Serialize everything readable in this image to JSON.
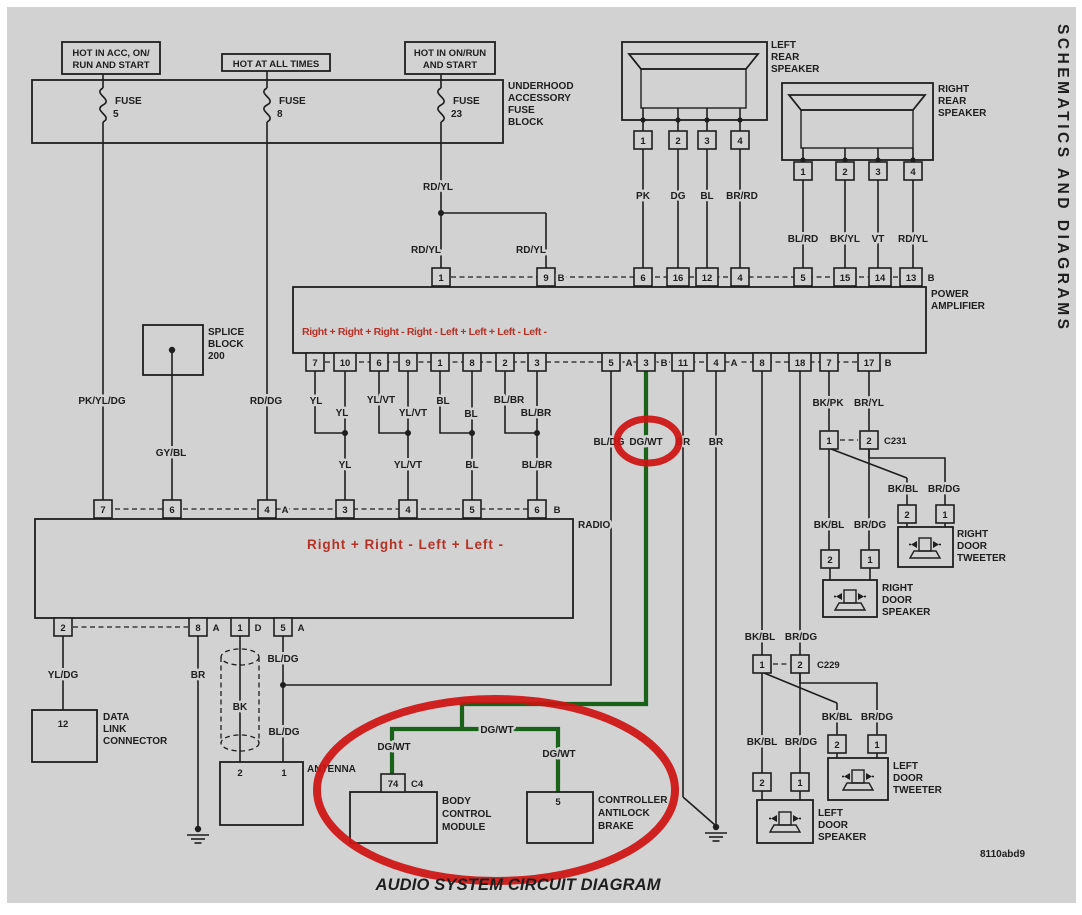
{
  "side_text": "SCHEMATICS AND DIAGRAMS",
  "caption": "AUDIO SYSTEM CIRCUIT DIAGRAM",
  "doc_code": "8110abd9",
  "colors": {
    "background": "#d2d2d2",
    "line": "#1e1e1e",
    "wire_green": "#1a611a",
    "annotation_red": "#cd1312",
    "channel_text_red": "#b53227"
  },
  "power": {
    "hot1_line1": "HOT IN ACC, ON/",
    "hot1_line2": "RUN AND START",
    "hot2": "HOT AT ALL TIMES",
    "hot3_line1": "HOT IN ON/RUN",
    "hot3_line2": "AND START",
    "block_line1": "UNDERHOOD",
    "block_line2": "ACCESSORY",
    "block_line3": "FUSE",
    "block_line4": "BLOCK",
    "fuse_word": "FUSE",
    "fuse1": "5",
    "fuse2": "8",
    "fuse3": "23"
  },
  "wire": {
    "rdyl": "RD/YL",
    "pkyldg": "PK/YL/DG",
    "rddg": "RD/DG",
    "gybl": "GY/BL",
    "yl": "YL",
    "ylvt": "YL/VT",
    "bl": "BL",
    "blbr": "BL/BR",
    "bldg": "BL/DG",
    "dgwt": "DG/WT",
    "br": "BR",
    "pk": "PK",
    "dg": "DG",
    "brrd": "BR/RD",
    "blrd": "BL/RD",
    "bkyl": "BK/YL",
    "vt": "VT",
    "bkpk": "BK/PK",
    "bryl": "BR/YL",
    "bkbl": "BK/BL",
    "brdg": "BR/DG",
    "yldg": "YL/DG",
    "bk": "BK"
  },
  "letters": {
    "a": "A",
    "b": "B",
    "d": "D"
  },
  "amp": {
    "name_line1": "POWER",
    "name_line2": "AMPLIFIER",
    "channels": "Right +  Right +  Right -  Right -  Left +  Left +  Left  -  Left -",
    "top_pins": [
      "1",
      "9",
      "6",
      "16",
      "12",
      "4",
      "5",
      "15",
      "14",
      "13"
    ],
    "bottom_pins": [
      "7",
      "10",
      "6",
      "9",
      "1",
      "8",
      "2",
      "3",
      "5",
      "3",
      "11",
      "4",
      "8",
      "18",
      "7",
      "17"
    ]
  },
  "radio": {
    "label": "RADIO",
    "channels": "Right +   Right -   Left +   Left -",
    "top_pins": [
      "7",
      "6",
      "4",
      "3",
      "4",
      "5",
      "6"
    ],
    "bottom_pins": [
      "2",
      "8",
      "1",
      "5"
    ]
  },
  "rear_left": {
    "l1": "LEFT",
    "l2": "REAR",
    "l3": "SPEAKER",
    "pins": [
      "1",
      "2",
      "3",
      "4"
    ]
  },
  "rear_right": {
    "l1": "RIGHT",
    "l2": "REAR",
    "l3": "SPEAKER",
    "pins": [
      "1",
      "2",
      "3",
      "4"
    ]
  },
  "splice": {
    "l1": "SPLICE",
    "l2": "BLOCK",
    "l3": "200"
  },
  "dlc": {
    "pin": "12",
    "l1": "DATA",
    "l2": "LINK",
    "l3": "CONNECTOR"
  },
  "antenna": {
    "label": "ANTENNA",
    "pin2": "2",
    "pin1": "1"
  },
  "bcm": {
    "pin": "74",
    "conn": "C4",
    "l1": "BODY",
    "l2": "CONTROL",
    "l3": "MODULE"
  },
  "abs": {
    "pin": "5",
    "l1": "CONTROLLER",
    "l2": "ANTILOCK",
    "l3": "BRAKE"
  },
  "connectors": {
    "c231": "C231",
    "c229": "C229"
  },
  "door": {
    "rt": {
      "l1": "RIGHT",
      "l2": "DOOR",
      "l3": "TWEETER",
      "pins": [
        "2",
        "1"
      ]
    },
    "rs": {
      "l1": "RIGHT",
      "l2": "DOOR",
      "l3": "SPEAKER",
      "pins": [
        "2",
        "1"
      ]
    },
    "lt": {
      "l1": "LEFT",
      "l2": "DOOR",
      "l3": "TWEETER",
      "pins": [
        "2",
        "1"
      ]
    },
    "ls": {
      "l1": "LEFT",
      "l2": "DOOR",
      "l3": "SPEAKER",
      "pins": [
        "2",
        "1"
      ]
    }
  }
}
